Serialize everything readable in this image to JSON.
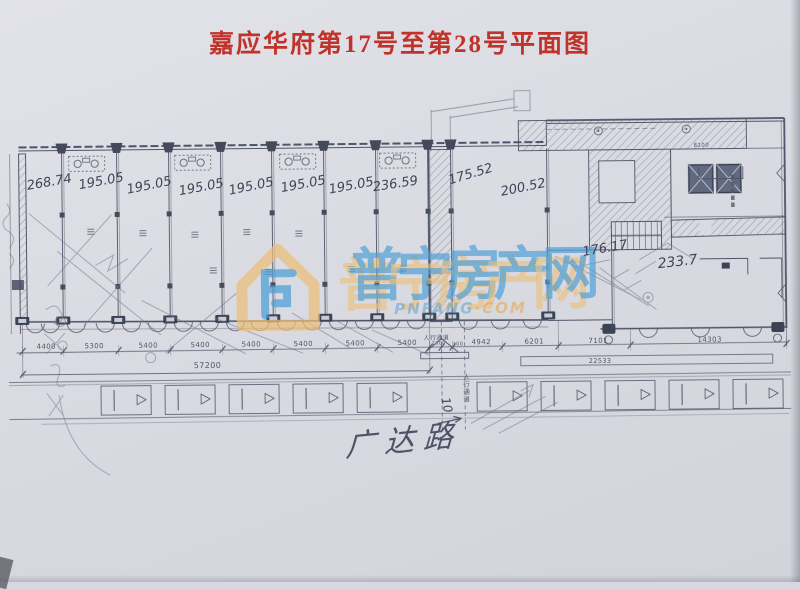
{
  "page": {
    "title": "嘉应华府第17号至第28号平面图"
  },
  "colors": {
    "title_red": "#c0332b",
    "ink": "#474d61",
    "pencil": "#70768f",
    "watermark_blue": "#4a9ed6",
    "watermark_yellow": "#ecbe78",
    "paper": "#dadbe2"
  },
  "watermark": {
    "site_name": "普宁房产网",
    "chars": [
      "普",
      "宁",
      "房",
      "产",
      "网"
    ],
    "domain_blue": "PNFANG",
    "domain_orange": "·COM",
    "logo": "house-p-logo"
  },
  "plan": {
    "labels": [
      {
        "t": "268.74",
        "x": 28,
        "y": 176,
        "fs": 13,
        "r": -9,
        "cls": "hw",
        "n": "unit-area-label"
      },
      {
        "t": "195.05",
        "x": 80,
        "y": 176,
        "fs": 13,
        "r": -10,
        "cls": "hw",
        "n": "unit-area-label"
      },
      {
        "t": "195.05",
        "x": 128,
        "y": 181,
        "fs": 13,
        "r": -11,
        "cls": "hw",
        "n": "unit-area-label"
      },
      {
        "t": "195.05",
        "x": 180,
        "y": 183,
        "fs": 13,
        "r": -10,
        "cls": "hw",
        "n": "unit-area-label"
      },
      {
        "t": "195.05",
        "x": 230,
        "y": 183,
        "fs": 13,
        "r": -11,
        "cls": "hw",
        "n": "unit-area-label"
      },
      {
        "t": "195.05",
        "x": 282,
        "y": 181,
        "fs": 13,
        "r": -10,
        "cls": "hw",
        "n": "unit-area-label"
      },
      {
        "t": "195.05",
        "x": 330,
        "y": 183,
        "fs": 13,
        "r": -10,
        "cls": "hw",
        "n": "unit-area-label"
      },
      {
        "t": "236.59",
        "x": 374,
        "y": 181,
        "fs": 13,
        "r": -8,
        "cls": "hw",
        "n": "unit-area-label"
      },
      {
        "t": "175.52",
        "x": 450,
        "y": 175,
        "fs": 13,
        "r": -16,
        "cls": "hw",
        "n": "unit-area-label"
      },
      {
        "t": "200.52",
        "x": 502,
        "y": 187,
        "fs": 13,
        "r": -11,
        "cls": "hw",
        "n": "unit-area-label"
      },
      {
        "t": "176.17",
        "x": 583,
        "y": 248,
        "fs": 13,
        "r": -9,
        "cls": "hw",
        "n": "unit-area-label"
      },
      {
        "t": "233.7",
        "x": 658,
        "y": 260,
        "fs": 14,
        "r": -6,
        "cls": "hw",
        "n": "unit-area-label"
      },
      {
        "t": "4400",
        "x": 36,
        "y": 340,
        "fs": 7,
        "cls": "dim-lbl",
        "n": "dimension-label"
      },
      {
        "t": "5300",
        "x": 84,
        "y": 340,
        "fs": 7,
        "cls": "dim-lbl",
        "n": "dimension-label"
      },
      {
        "t": "5400",
        "x": 138,
        "y": 340,
        "fs": 7,
        "cls": "dim-lbl",
        "n": "dimension-label"
      },
      {
        "t": "5400",
        "x": 190,
        "y": 340,
        "fs": 7,
        "cls": "dim-lbl",
        "n": "dimension-label"
      },
      {
        "t": "5400",
        "x": 241,
        "y": 340,
        "fs": 7,
        "cls": "dim-lbl",
        "n": "dimension-label"
      },
      {
        "t": "5400",
        "x": 293,
        "y": 340,
        "fs": 7,
        "cls": "dim-lbl",
        "n": "dimension-label"
      },
      {
        "t": "5400",
        "x": 345,
        "y": 340,
        "fs": 7,
        "cls": "dim-lbl",
        "n": "dimension-label"
      },
      {
        "t": "5400",
        "x": 397,
        "y": 340,
        "fs": 7,
        "cls": "dim-lbl",
        "n": "dimension-label"
      },
      {
        "t": "2300",
        "x": 431,
        "y": 342,
        "fs": 5,
        "cls": "dim-lbl",
        "n": "dimension-label"
      },
      {
        "t": "100",
        "x": 452,
        "y": 343,
        "fs": 5,
        "cls": "dim-lbl",
        "n": "dimension-label"
      },
      {
        "t": "4942",
        "x": 471,
        "y": 340,
        "fs": 7,
        "cls": "dim-lbl",
        "n": "dimension-label"
      },
      {
        "t": "6201",
        "x": 524,
        "y": 340,
        "fs": 7,
        "cls": "dim-lbl",
        "n": "dimension-label"
      },
      {
        "t": "7101",
        "x": 588,
        "y": 340,
        "fs": 7,
        "cls": "dim-lbl",
        "n": "dimension-label"
      },
      {
        "t": "14303",
        "x": 697,
        "y": 340,
        "fs": 7,
        "cls": "dim-lbl",
        "n": "dimension-label"
      },
      {
        "t": "57200",
        "x": 193,
        "y": 360,
        "fs": 8,
        "cls": "dim-lbl",
        "n": "total-dimension"
      },
      {
        "t": "22533",
        "x": 588,
        "y": 360,
        "fs": 6.5,
        "cls": "dim-lbl",
        "n": "total-dimension"
      },
      {
        "t": "人行通道",
        "x": 423,
        "y": 336,
        "fs": 6,
        "cls": "dim-lbl",
        "n": "passage-label"
      },
      {
        "t": "人行通道",
        "x": 461,
        "y": 374,
        "fs": 6.5,
        "v": 1,
        "cls": "dim-lbl",
        "n": "corridor-label"
      },
      {
        "t": "10",
        "x": 444,
        "y": 392,
        "fs": 12,
        "r": 78,
        "cls": "hw",
        "n": "handwritten-note-10"
      },
      {
        "t": "8100",
        "x": 695,
        "y": 147,
        "fs": 5.5,
        "cls": "dim-lbl",
        "n": "dimension-label"
      },
      {
        "t": "广达路",
        "x": 344,
        "y": 432,
        "fs": 30,
        "cls": "hw-road",
        "n": "road-label"
      }
    ]
  }
}
